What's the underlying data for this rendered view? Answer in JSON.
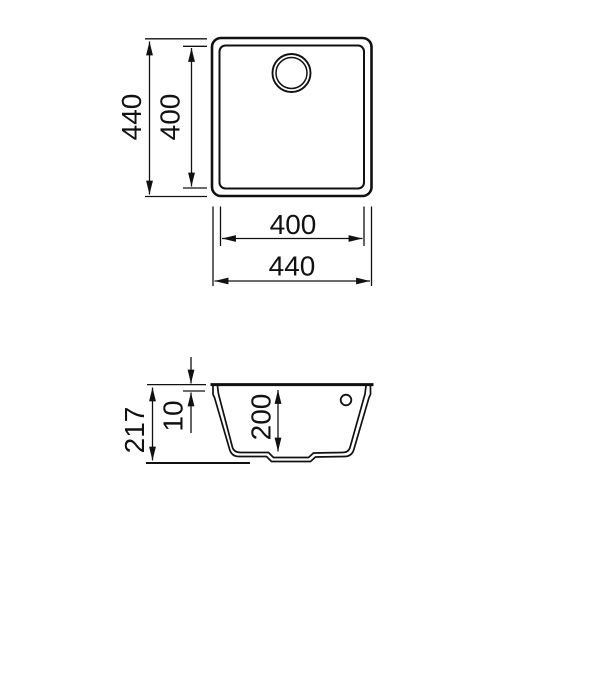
{
  "drawing": {
    "type": "sink-dimension-drawing",
    "views": [
      "top-view",
      "side-section-view"
    ],
    "colors": {
      "line": "#111111",
      "background": "#ffffff"
    }
  },
  "dimensions": {
    "top_view": {
      "outer_height": "440",
      "bowl_height": "400",
      "bowl_width": "400",
      "outer_width": "440"
    },
    "side_view": {
      "total_height": "217",
      "rim_thickness": "10",
      "bowl_depth": "200"
    }
  }
}
